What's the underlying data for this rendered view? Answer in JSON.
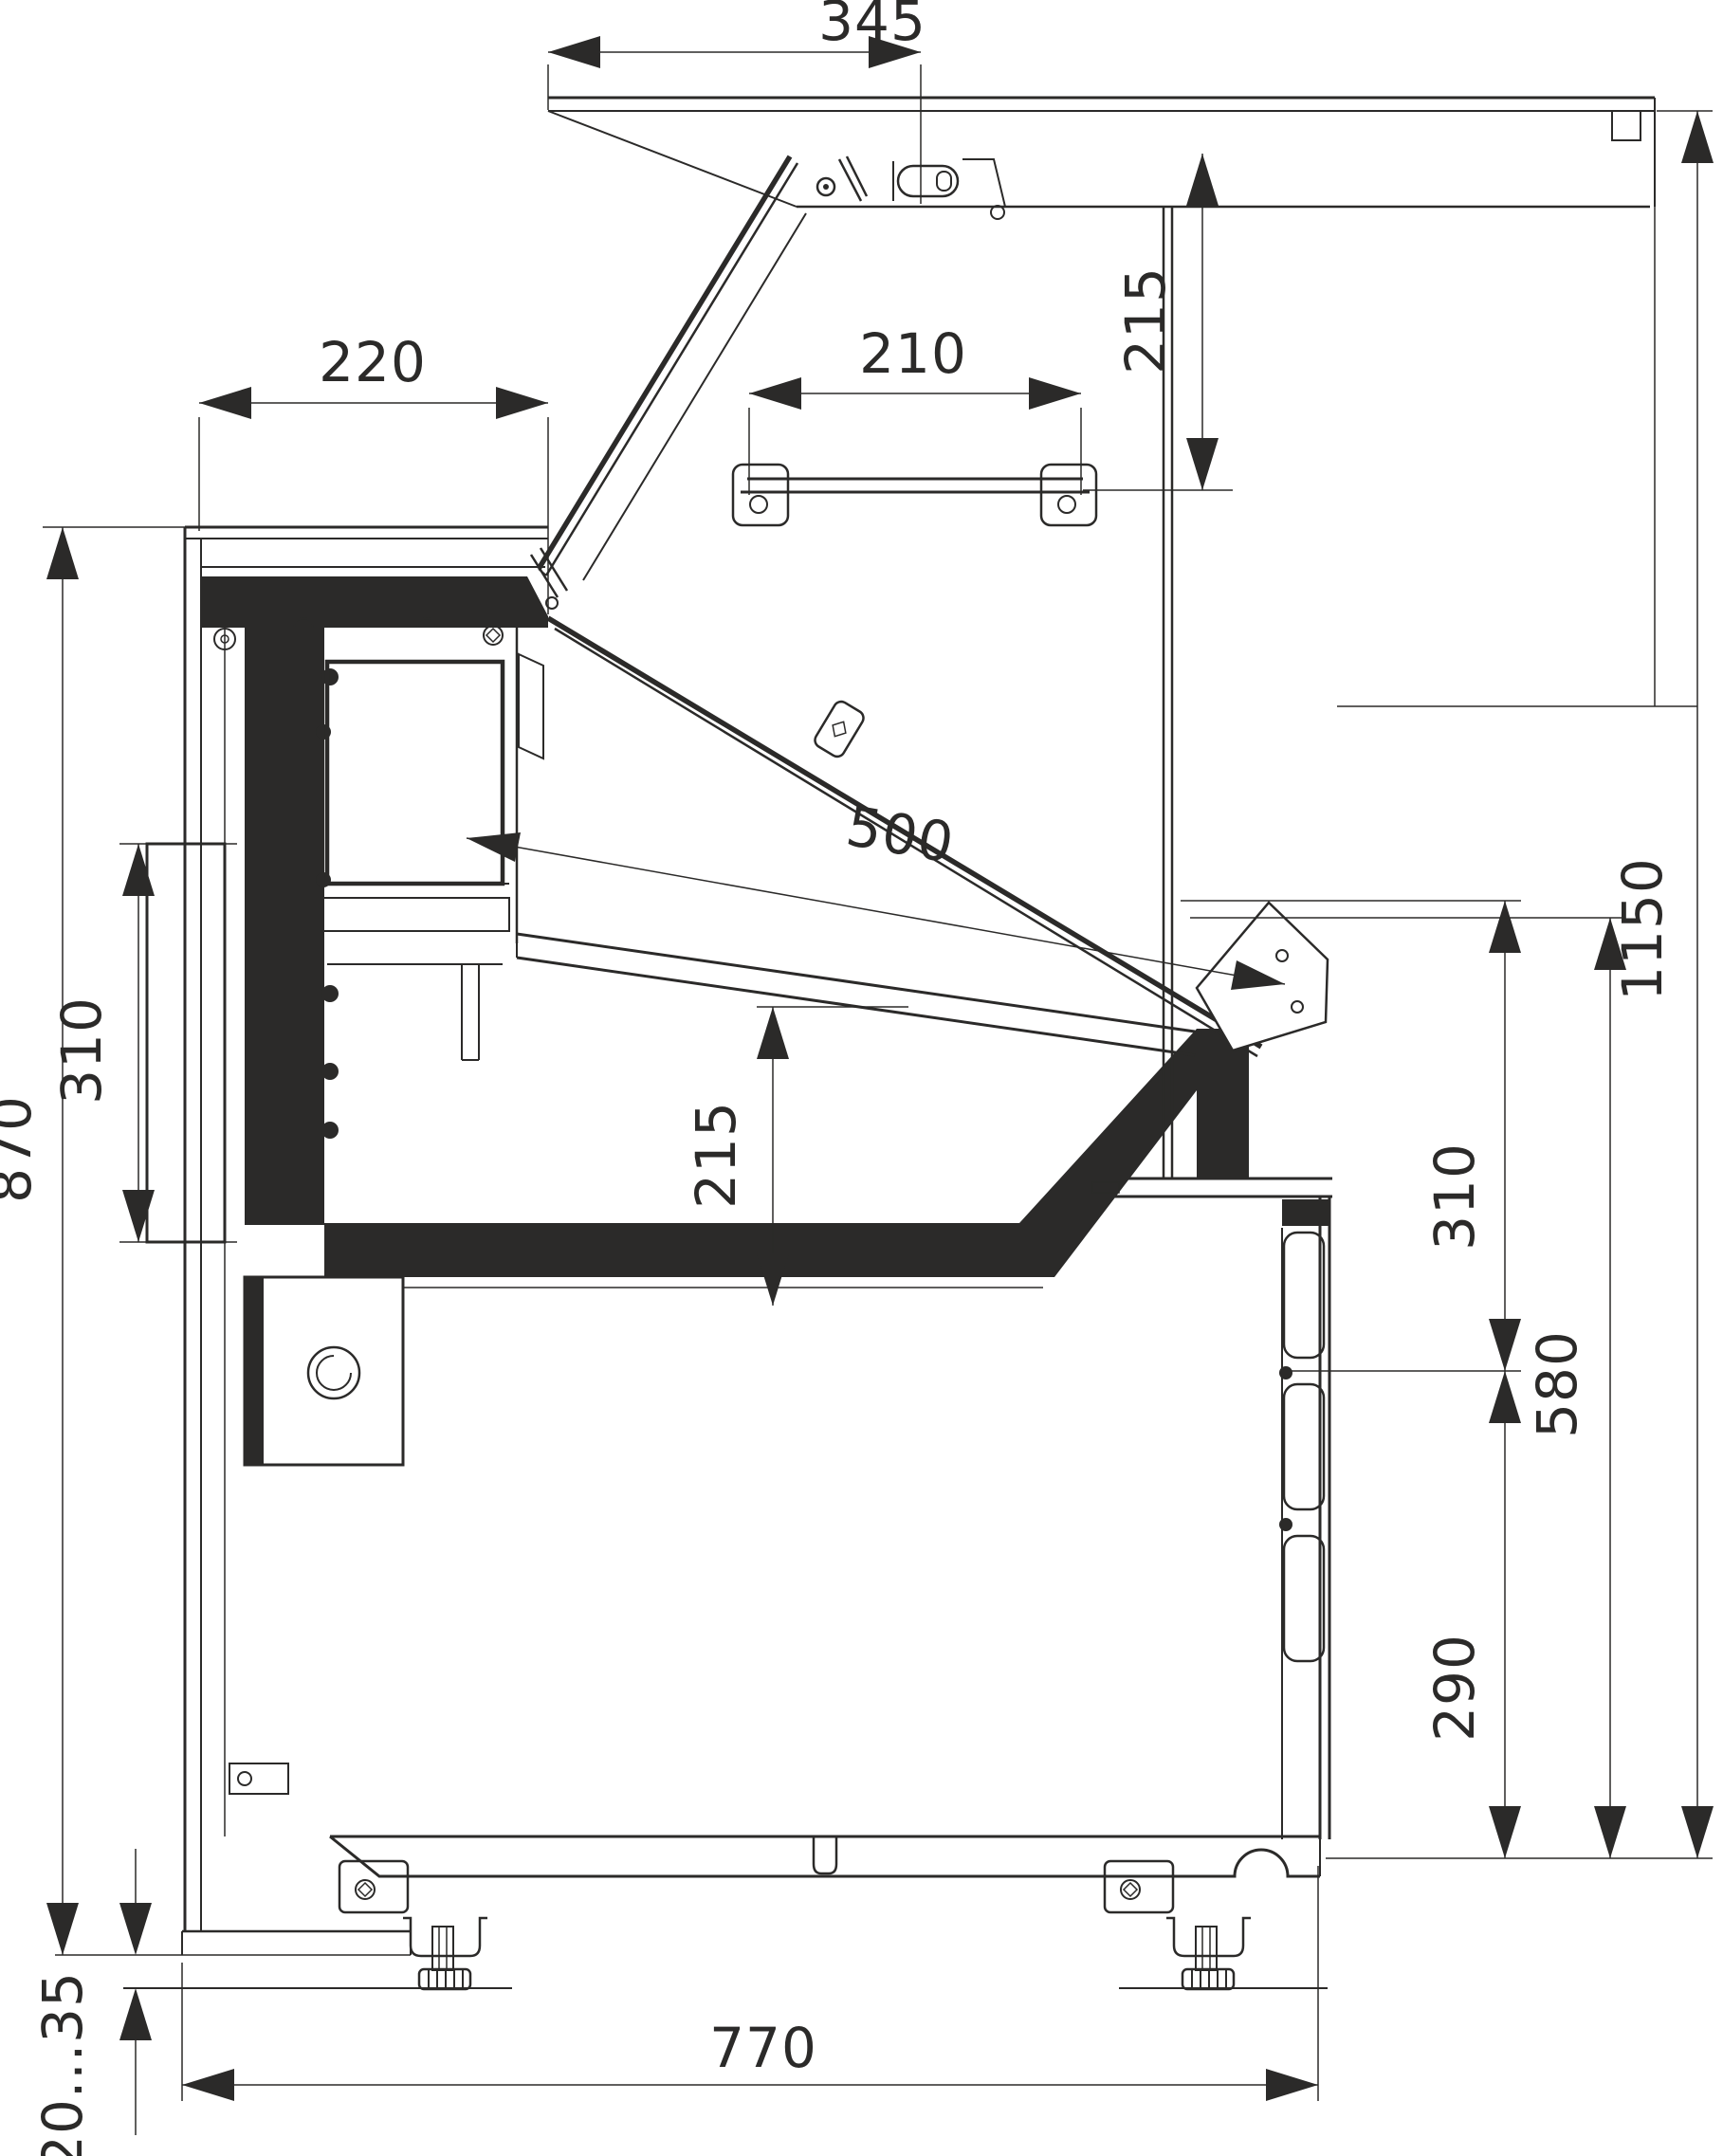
{
  "drawing": {
    "kind": "refrigerated-display-case-side-section",
    "line_color": "#2b2a29",
    "background": "#ffffff",
    "dims": {
      "canopy_depth": "345",
      "canopy_front_height": "215",
      "counter_depth": "220",
      "shelf_length": "210",
      "display_glass_length": "500",
      "well_inner_height": "215",
      "rear_panel_height": "310",
      "rear_working_height": "870",
      "overall_height": "1150",
      "front_glass_height": "310",
      "front_body_height": "580",
      "vent_panel_height": "290",
      "leveling_feet_range": "20...35",
      "overall_depth": "770"
    }
  }
}
